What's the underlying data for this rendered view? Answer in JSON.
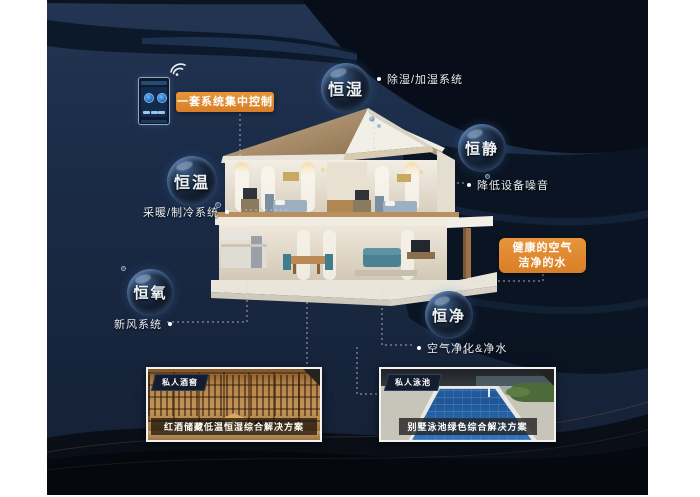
{
  "control": {
    "label": "一套系统集中控制",
    "wifi_icon": "wifi-signal"
  },
  "callout": {
    "line1": "健康的空气",
    "line2": "洁净的水"
  },
  "bubbles": [
    {
      "id": "hengshi",
      "label": "恒湿",
      "note": "除湿/加湿系统"
    },
    {
      "id": "hengjing",
      "label": "恒静",
      "note": "降低设备噪音"
    },
    {
      "id": "hengwen",
      "label": "恒温",
      "note": "采暖/制冷系统"
    },
    {
      "id": "hengyang",
      "label": "恒氧",
      "note": "新风系统"
    },
    {
      "id": "hengjing2",
      "label": "恒净",
      "note": "空气净化&净水"
    }
  ],
  "photos": [
    {
      "badge": "私人酒窖",
      "caption": "红酒储藏低温恒湿综合解决方案"
    },
    {
      "badge": "私人泳池",
      "caption": "别墅泳池绿色综合解决方案"
    }
  ],
  "colors": {
    "accent_orange": "#df8831",
    "background_navy": "#1b2c49",
    "swoosh_dark": "#0a121f",
    "text_light": "#e9edf2"
  }
}
